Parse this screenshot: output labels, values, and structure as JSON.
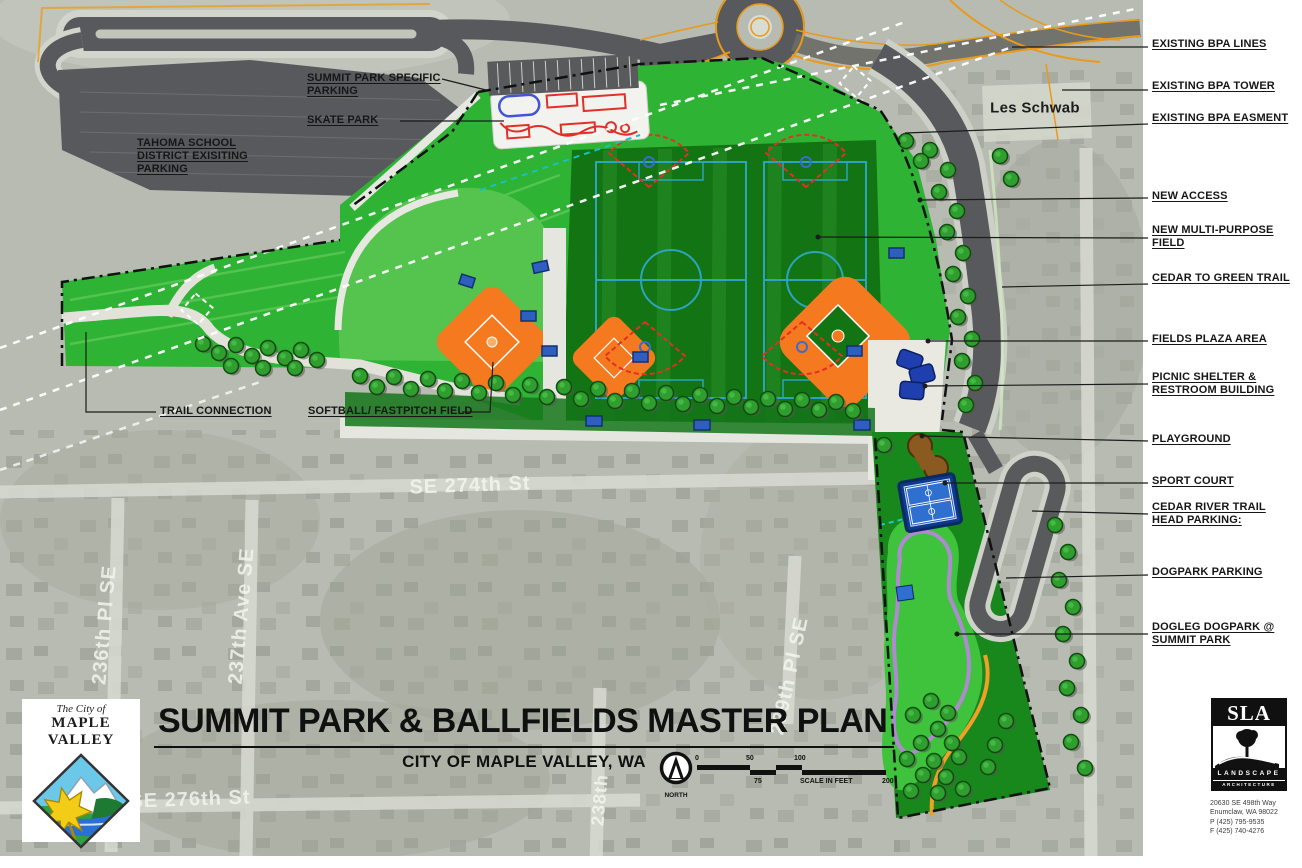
{
  "document": {
    "title": "SUMMIT PARK & BALLFIELDS MASTER PLAN",
    "subtitle": "CITY OF MAPLE VALLEY, WA"
  },
  "city_logo": {
    "pretitle": "The City of",
    "city_name": "MAPLE VALLEY"
  },
  "north": {
    "label": "NORTH"
  },
  "scale_bar": {
    "tick0": "0",
    "tick50": "50",
    "tick100": "100",
    "tick75": "75",
    "units_label": "SCALE IN FEET",
    "tick200": "200"
  },
  "callouts_right": [
    {
      "text": "EXISTING BPA LINES"
    },
    {
      "text": "EXISTING BPA TOWER"
    },
    {
      "text": "EXISTING BPA EASMENT"
    },
    {
      "text": "NEW ACCESS"
    },
    {
      "text": "NEW MULTI-PURPOSE FIELD"
    },
    {
      "text": "CEDAR TO GREEN TRAIL"
    },
    {
      "text": "FIELDS PLAZA AREA"
    },
    {
      "text": "PICNIC SHELTER & RESTROOM BUILDING"
    },
    {
      "text": "PLAYGROUND"
    },
    {
      "text": "SPORT COURT"
    },
    {
      "text": "CEDAR RIVER TRAIL HEAD PARKING:"
    },
    {
      "text": "DOGPARK PARKING"
    },
    {
      "text": "DOGLEG DOGPARK @ SUMMIT PARK"
    }
  ],
  "callouts_map": [
    {
      "text": "SUMMIT PARK SPECIFIC PARKING"
    },
    {
      "text": "SKATE PARK"
    },
    {
      "text": "TAHOMA SCHOOL DISTRICT EXISITING PARKING"
    },
    {
      "text": "TRAIL CONNECTION"
    },
    {
      "text": "SOFTBALL/ FASTPITCH FIELD"
    }
  ],
  "street_labels": [
    {
      "text": "SE 274th St"
    },
    {
      "text": "236th Pl SE"
    },
    {
      "text": "237th Ave SE"
    },
    {
      "text": "239th Pl SE"
    },
    {
      "text": "238th"
    },
    {
      "text": "SE 276th St"
    },
    {
      "text": "Les Schwab"
    }
  ],
  "firm": {
    "initials": "SLA",
    "band1": "LANDSCAPE",
    "band2": "ARCHITECTURE",
    "address1": "20630 SE 498th Way",
    "address2": "Enumclaw, WA 98022",
    "phone": "P (425) 795-9535",
    "fax": "F (425) 740-4276"
  },
  "map_colors": {
    "park_green": "#2eb335",
    "field_dark_green": "#137413",
    "outfield_light_green": "#55c44e",
    "dogpark_green": "#3fc23c",
    "infield_orange": "#f4791f",
    "ballfield_red": "#e23022",
    "road_gray": "#58595c",
    "path_white": "#e8e8e2",
    "court_blue": "#1d5ac0",
    "playground_brown": "#8a5a20",
    "dog_trail_purple": "#b08ad0",
    "dog_trail_orange": "#f0a028",
    "roundabout_orange": "#e89a1a",
    "bpa_line_white": "#ffffff",
    "boundary_black": "#111111"
  }
}
